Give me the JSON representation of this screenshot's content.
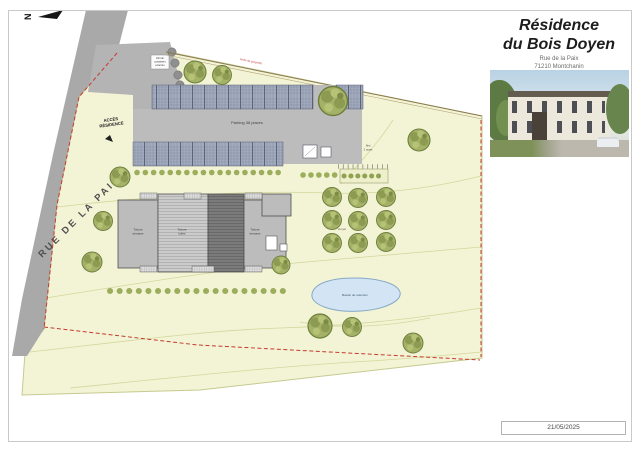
{
  "north_label": "N",
  "road": {
    "name": "RUE DE LA PAIX"
  },
  "plan": {
    "access_lines": [
      "ACCÈS",
      "RÉSIDENCE"
    ],
    "containers_lines": [
      "Abri de",
      "containers",
      "enterrés"
    ],
    "boundary_label": "limite de propriété",
    "parking_label": "Parking 38 places",
    "orchard_label": "Verger",
    "pond_label": "Bassin de rétention",
    "shelter_lines": [
      "Abri",
      "2 roues"
    ],
    "building_roof_labels": {
      "left": [
        "Toiture",
        "terrasse"
      ],
      "middle": [
        "Toiture",
        "tuiles"
      ],
      "right": [
        "Toiture",
        "terrasse"
      ]
    }
  },
  "panel": {
    "title_lines": [
      "Résidence",
      "du Bois Doyen"
    ],
    "address_lines": [
      "Rue de la Paix",
      "71210 Montchanin"
    ],
    "date": "21/05/2025"
  },
  "colors": {
    "parcel": "#f3f4d6",
    "road": "#a9a9a9",
    "boundary_red": "#c43b2e",
    "pond": "#d3e5f5",
    "tree_green": "#a3b266"
  }
}
